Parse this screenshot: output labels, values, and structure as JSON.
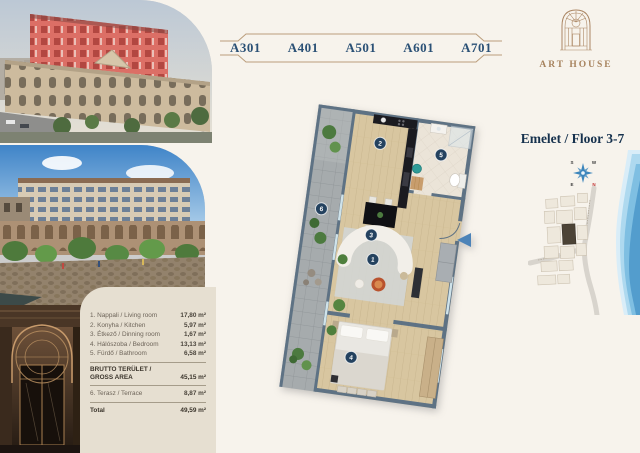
{
  "unit_selector": {
    "items": [
      "A301",
      "A401",
      "A501",
      "A601",
      "A701"
    ]
  },
  "logo": {
    "title": "ART HOUSE"
  },
  "floor": {
    "label": "Emelet / Floor 3-7"
  },
  "compass": {
    "top_left": "S",
    "top_right": "W",
    "bottom_left": "E",
    "bottom_right": "N"
  },
  "area_table": {
    "rows": [
      {
        "label": "1. Nappali / Living room",
        "value": "17,80 m²"
      },
      {
        "label": "2. Konyha / Kitchen",
        "value": "5,97 m²"
      },
      {
        "label": "3. Étkező / Dinning room",
        "value": "1,67 m²"
      },
      {
        "label": "4. Hálószoba / Bedroom",
        "value": "13,13 m²"
      },
      {
        "label": "5. Fürdő / Bathroom",
        "value": "6,58 m²"
      }
    ],
    "gross_label_line1": "BRUTTO TERÜLET /",
    "gross_label_line2": "GROSS AREA",
    "gross_value": "45,15 m²",
    "terrace_label": "6. Terasz / Terrace",
    "terrace_value": "8,87 m²",
    "total_label": "Total",
    "total_value": "49,59 m²"
  },
  "floor_plan": {
    "rooms": [
      {
        "num": "1",
        "name": "living room"
      },
      {
        "num": "2",
        "name": "kitchen"
      },
      {
        "num": "3",
        "name": "dining"
      },
      {
        "num": "4",
        "name": "bedroom"
      },
      {
        "num": "5",
        "name": "bathroom"
      },
      {
        "num": "6",
        "name": "terrace"
      }
    ]
  },
  "colors": {
    "accent_navy": "#24425f",
    "accent_tan": "#bb9d7b",
    "wall": "#5e7284",
    "brand_text": "#a7835e",
    "arrow_blue": "#4c83b8",
    "panel_bg": "#e6dfd1"
  }
}
